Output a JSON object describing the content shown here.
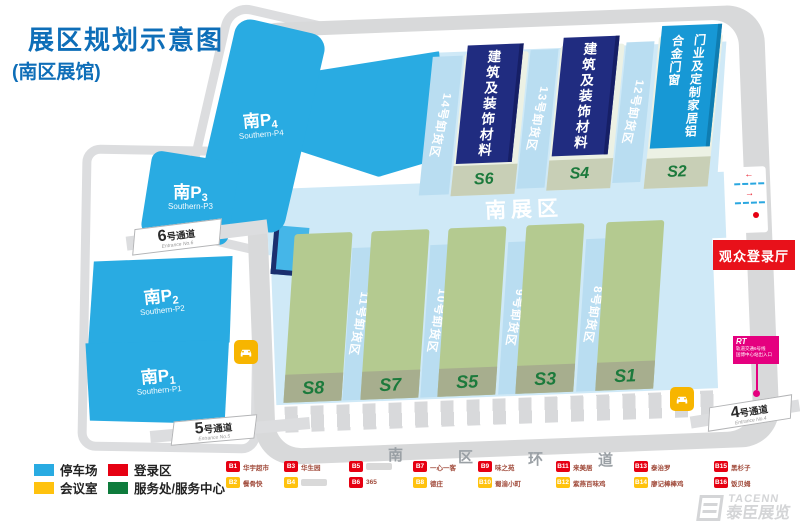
{
  "title": {
    "main": "展区规划示意图",
    "sub": "(南区展馆)"
  },
  "parking": [
    {
      "zh": "南P",
      "num": "4",
      "en": "Southern-P4"
    },
    {
      "zh": "南P",
      "num": "3",
      "en": "Southern-P3"
    },
    {
      "zh": "南P",
      "num": "2",
      "en": "Southern-P2"
    },
    {
      "zh": "南P",
      "num": "1",
      "en": "Southern-P1"
    }
  ],
  "passages": [
    {
      "num": "6",
      "sfx": "号通道",
      "en": "Entrance No.6"
    },
    {
      "num": "5",
      "sfx": "号通道",
      "en": "Entrance No.5"
    },
    {
      "num": "4",
      "sfx": "号通道",
      "en": "Entrance No.4"
    }
  ],
  "plaza": {
    "label": "南展区"
  },
  "halls_top": [
    {
      "id": "S6",
      "banner": "建筑及装饰材料"
    },
    {
      "id": "S4",
      "banner": "建筑及装饰材料"
    },
    {
      "id": "S2",
      "banner": "门业及定制家居铝合金门窗"
    }
  ],
  "docks_top": [
    "14号卸货区",
    "13号卸货区",
    "12号卸货区"
  ],
  "halls_bottom": [
    {
      "id": "S8"
    },
    {
      "id": "S7"
    },
    {
      "id": "S5"
    },
    {
      "id": "S3"
    },
    {
      "id": "S1"
    }
  ],
  "docks_bottom": [
    "11号卸货区",
    "10号卸货区",
    "9号卸货区",
    "8号卸货区"
  ],
  "registration_hall": "观众登录厅",
  "metro": {
    "logo": "RT",
    "line1": "轨道交通6号线",
    "line2": "国博中心站出入口"
  },
  "ring_road_chars": [
    "南",
    "区",
    "环",
    "道"
  ],
  "legend": {
    "swatches": [
      {
        "label": "停车场",
        "color": "#29abe2"
      },
      {
        "label": "会议室",
        "color": "#ffc20e"
      },
      {
        "label": "登录区",
        "color": "#e60012"
      },
      {
        "label": "服务处/服务中心",
        "color": "#0e7b3c"
      }
    ],
    "vendors": [
      {
        "id": "B1",
        "color": "#e60012",
        "label": "华宇超市"
      },
      {
        "id": "B2",
        "color": "#ffc20e",
        "label": "餐骨快"
      },
      {
        "id": "B3",
        "color": "#e60012",
        "label": "华生园"
      },
      {
        "id": "B4",
        "color": "#ffc20e",
        "label": ""
      },
      {
        "id": "B5",
        "color": "#e60012",
        "label": ""
      },
      {
        "id": "B6",
        "color": "#e60012",
        "label": "365"
      },
      {
        "id": "B7",
        "color": "#e60012",
        "label": "一心一客"
      },
      {
        "id": "B8",
        "color": "#ffc20e",
        "label": "德庄"
      },
      {
        "id": "B9",
        "color": "#e60012",
        "label": "味之苑"
      },
      {
        "id": "B10",
        "color": "#ffc20e",
        "label": "蜀渝小町"
      },
      {
        "id": "B11",
        "color": "#e60012",
        "label": "来美居"
      },
      {
        "id": "B12",
        "color": "#ffc20e",
        "label": "紫燕百味鸡"
      },
      {
        "id": "B13",
        "color": "#e60012",
        "label": "泰治罗"
      },
      {
        "id": "B14",
        "color": "#ffc20e",
        "label": "廖记棒棒鸡"
      },
      {
        "id": "B15",
        "color": "#e60012",
        "label": "黑杉子"
      },
      {
        "id": "B16",
        "color": "#e60012",
        "label": "饭贝姆"
      }
    ]
  },
  "watermark": {
    "en": "TACENN",
    "zh": "泰臣展览"
  },
  "colors": {
    "parking_blue": "#29abe2",
    "hall_green": "#b4ca90",
    "banner_navy": "#202c80",
    "banner_blue": "#1798d5",
    "registration_red": "#e8111a",
    "metro_magenta": "#e5007f",
    "plaza_blue": "#cfe9f7",
    "title_blue": "#0e6eb8",
    "road_gray": "#d8d9da"
  }
}
